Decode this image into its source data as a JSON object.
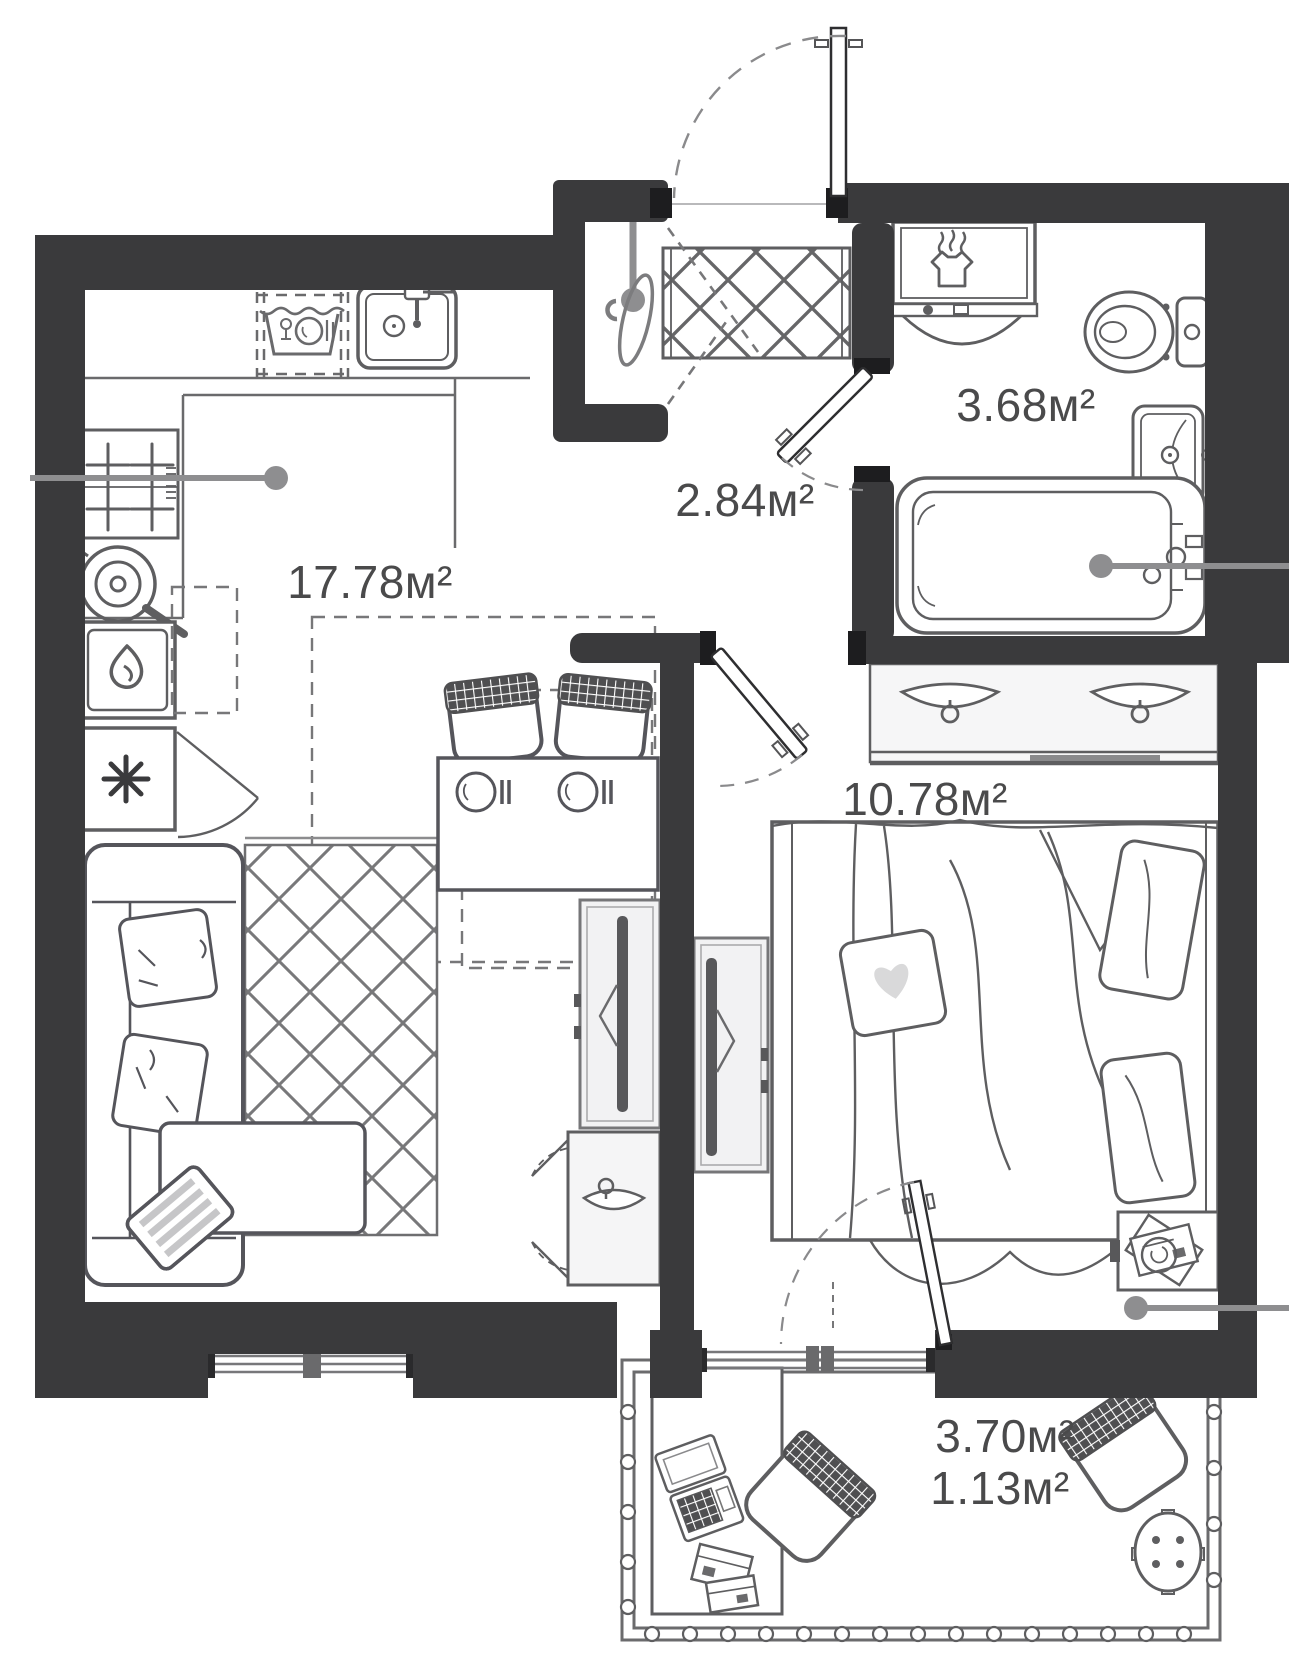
{
  "plan": {
    "rooms": [
      {
        "id": "kitchen-living-room",
        "area_label": "17.78м²"
      },
      {
        "id": "hallway",
        "area_label": "2.84м²"
      },
      {
        "id": "bathroom",
        "area_label": "3.68м²"
      },
      {
        "id": "bedroom",
        "area_label": "10.78м²"
      },
      {
        "id": "balcony",
        "area_label": "3.70м²",
        "area_label_reduced": "1.13м²"
      }
    ],
    "colors": {
      "wall": "#3a3a3c",
      "outline": "#5e5e60",
      "light_fill": "#f2f2f3",
      "leader": "#8e8e90",
      "label_text": "#4a4a4b"
    },
    "fixtures": [
      "entry-door",
      "hall-wardrobe",
      "mirror",
      "wall-hook",
      "bathroom-door",
      "washer-dryer",
      "toilet",
      "washbasin",
      "bathtub",
      "kitchen-counter",
      "dishwasher",
      "kitchen-sink",
      "stove",
      "pan",
      "oven",
      "refrigerator",
      "dining-table",
      "dining-chair",
      "sofa",
      "rug",
      "coffee-table",
      "tv-unit",
      "hanger-closet",
      "double-bed",
      "heart-pillow",
      "bedroom-wardrobe",
      "clothes-hanger",
      "nightstand",
      "balcony-railing",
      "balcony-desk",
      "laptop",
      "office-chair",
      "round-stool",
      "window",
      "leader-mark"
    ]
  }
}
